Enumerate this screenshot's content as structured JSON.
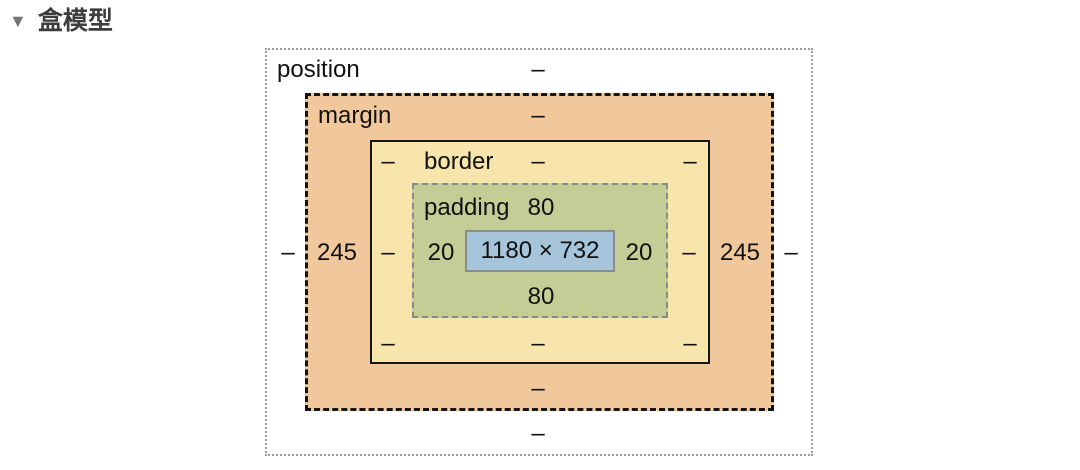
{
  "header": {
    "disclosure": "▼",
    "title": "盒模型"
  },
  "box_model": {
    "position": {
      "label": "position",
      "top": "–",
      "left": "–",
      "right": "–",
      "bottom": "–"
    },
    "margin": {
      "label": "margin",
      "top": "–",
      "left": "245",
      "right": "245",
      "bottom": "–"
    },
    "border": {
      "label": "border",
      "top": "–",
      "left": "–",
      "right": "–",
      "bottom": "–",
      "top_left": "–",
      "top_right": "–",
      "bottom_left": "–",
      "bottom_right": "–"
    },
    "padding": {
      "label": "padding",
      "top": "80",
      "left": "20",
      "right": "20",
      "bottom": "80"
    },
    "content": {
      "value": "1180 × 732"
    },
    "colors": {
      "position": "#FFFFFF",
      "margin": "#F1C89C",
      "border": "#F8E5AB",
      "padding": "#C5CD96",
      "content": "#A6C5DA"
    }
  }
}
